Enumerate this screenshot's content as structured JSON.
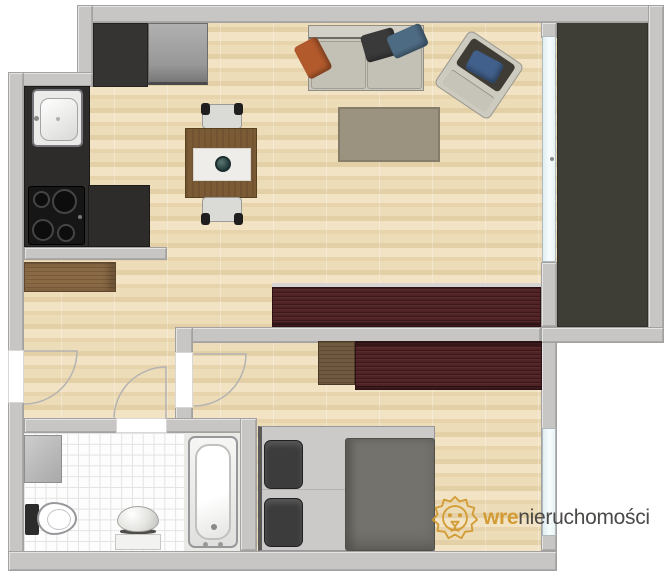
{
  "watermark": {
    "brand_bold": "wre",
    "brand_rest": "nieruchomości",
    "brand_gold": "#d29a32",
    "brand_text_dark": "#474543",
    "icon": "lion-head-icon"
  },
  "palette": {
    "outside": "#ffffff",
    "wall": "#c7c6c4",
    "wood_floor": "#ecdcba",
    "balcony_floor": "#3f3e36",
    "kitchen_counter": "#2d2c2a",
    "wardrobe_mahogany": "#502327",
    "hall_cabinet_walnut": "#8a6a45",
    "bedroom_dresser_walnut": "#6f5940",
    "rug": "#9c9280",
    "sofa": "#c8c5bb",
    "pillow_orange": "#b25a2c",
    "pillow_blue": "#4d6b83",
    "bed_duvet": "#73726c",
    "bathroom_tile": "#fdfdfd",
    "glass": "#e4f0f4"
  },
  "floor_plan": {
    "type": "apartment-top-view",
    "rooms": [
      {
        "name": "living-room-with-kitchen",
        "items": [
          "kitchen counter with sink",
          "cooktop with 4 burners",
          "tall dark cabinet",
          "stainless appliance",
          "dining table with bowl and 2 chairs",
          "sofa with orange, charcoal and blue pillows",
          "rotated armchair with blue pillow",
          "rug",
          "long mahogany wardrobe"
        ]
      },
      {
        "name": "balcony",
        "items": []
      },
      {
        "name": "hallway",
        "items": [
          "low walnut cabinet"
        ]
      },
      {
        "name": "bedroom",
        "items": [
          "double bed with two dark pillows and gray duvet",
          "mahogany wardrobe",
          "walnut dresser"
        ]
      },
      {
        "name": "bathroom",
        "items": [
          "bathtub",
          "washbasin vanity",
          "toilet",
          "bidet"
        ]
      }
    ],
    "openings": [
      "entrance door in left wall",
      "hallway to bathroom door",
      "hallway to bedroom door",
      "glass door to balcony",
      "bedroom window in right wall"
    ]
  }
}
